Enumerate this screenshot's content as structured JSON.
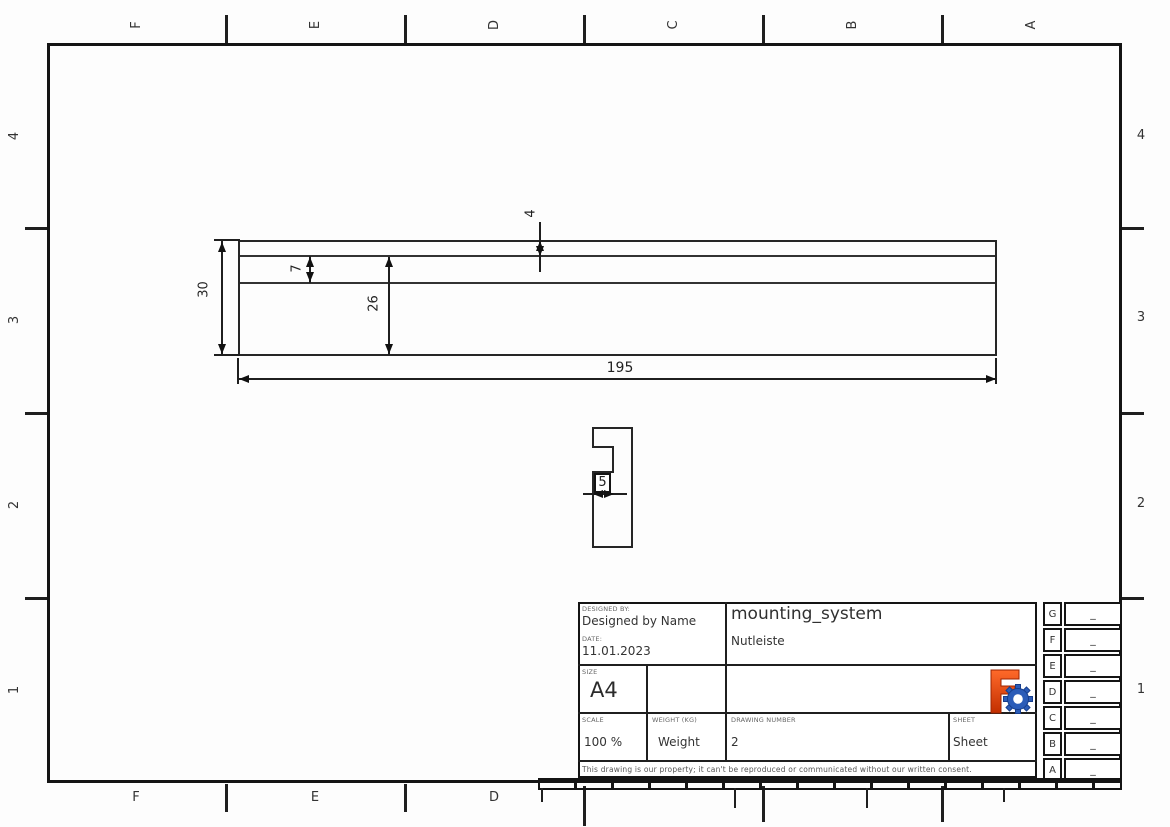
{
  "zones": {
    "top": [
      "F",
      "E",
      "D",
      "C",
      "B",
      "A"
    ],
    "bottom": [
      "F",
      "E",
      "D"
    ],
    "left": [
      "4",
      "3",
      "2",
      "1"
    ],
    "right": [
      "4",
      "3",
      "2",
      "1"
    ]
  },
  "dims": {
    "length": "195",
    "height": "30",
    "lip": "4",
    "groove": "7",
    "lower": "26",
    "depth": "5"
  },
  "title_block": {
    "designed_by_label": "DESIGNED BY:",
    "designed_by": "Designed by Name",
    "date_label": "DATE:",
    "date": "11.01.2023",
    "title": "mounting_system",
    "subtitle": "Nutleiste",
    "size_label": "SIZE",
    "size": "A4",
    "scale_label": "SCALE",
    "scale": "100 %",
    "weight_label": "WEIGHT (KG)",
    "weight": "Weight",
    "number_label": "DRAWING NUMBER",
    "number": "2",
    "sheet_label": "SHEET",
    "sheet": "Sheet",
    "disclaimer": "This drawing is our property; it can't be reproduced or communicated without our written consent."
  },
  "revisions": [
    {
      "zone": "G",
      "entry": "_"
    },
    {
      "zone": "F",
      "entry": "_"
    },
    {
      "zone": "E",
      "entry": "_"
    },
    {
      "zone": "D",
      "entry": "_"
    },
    {
      "zone": "C",
      "entry": "_"
    },
    {
      "zone": "B",
      "entry": "_"
    },
    {
      "zone": "A",
      "entry": "_"
    }
  ],
  "colors": {
    "line": "#1f1f1f",
    "logo_f_top": "#ff6a2a",
    "logo_f_bottom": "#c22e00",
    "logo_gear": "#2b5cb8",
    "logo_gear_dark": "#173e8c"
  }
}
